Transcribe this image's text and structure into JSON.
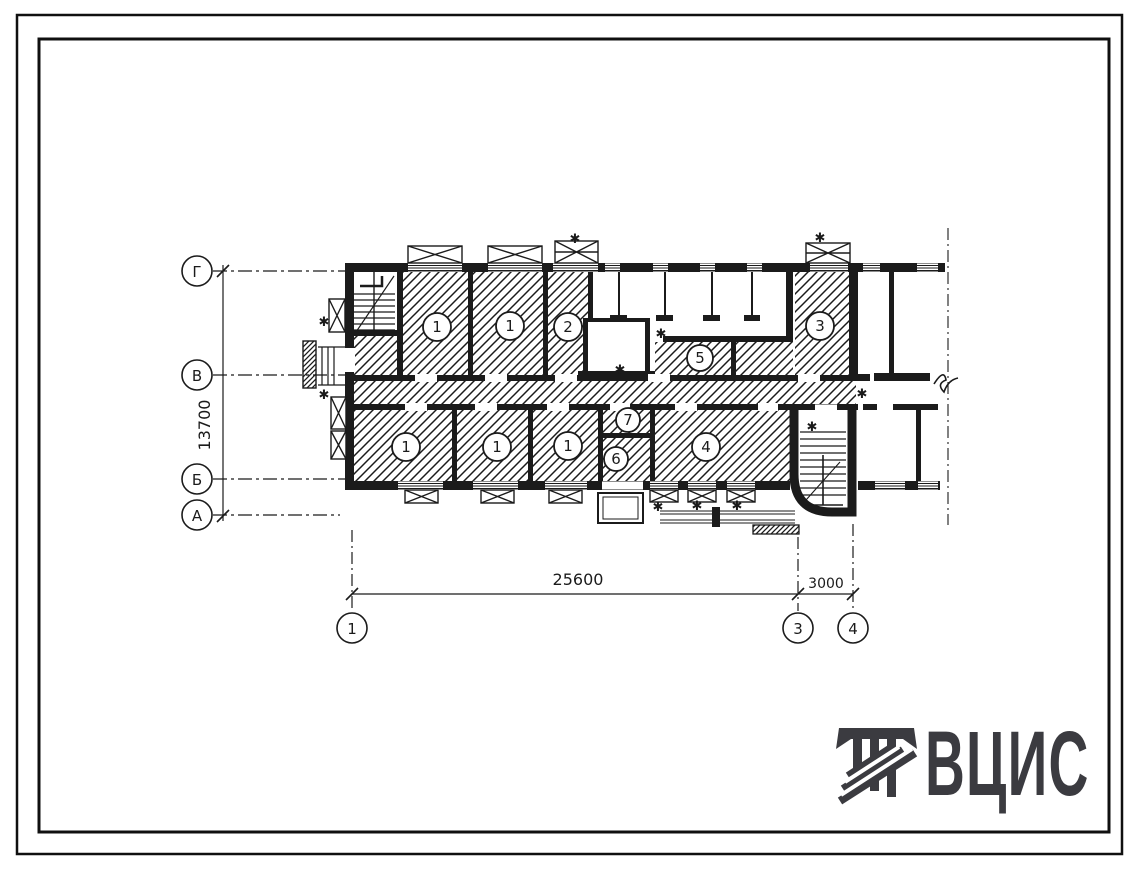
{
  "colors": {
    "ink": "#1b1b1b",
    "paper": "#ffffff",
    "logo": "#3b3b40"
  },
  "plan": {
    "row_axes": [
      {
        "label": "Г"
      },
      {
        "label": "В"
      },
      {
        "label": "Б"
      },
      {
        "label": "А"
      }
    ],
    "col_axes": [
      {
        "label": "1"
      },
      {
        "label": "3"
      },
      {
        "label": "4"
      }
    ],
    "dims": {
      "vertical": "13700",
      "main": "25600",
      "side": "3000"
    },
    "rooms": [
      {
        "label": "1"
      },
      {
        "label": "1"
      },
      {
        "label": "2"
      },
      {
        "label": "3"
      },
      {
        "label": "5"
      },
      {
        "label": "1"
      },
      {
        "label": "1"
      },
      {
        "label": "1"
      },
      {
        "label": "7"
      },
      {
        "label": "6"
      },
      {
        "label": "4"
      }
    ],
    "star_glyph": "✱"
  },
  "logo": {
    "text": "ВЦИС"
  }
}
